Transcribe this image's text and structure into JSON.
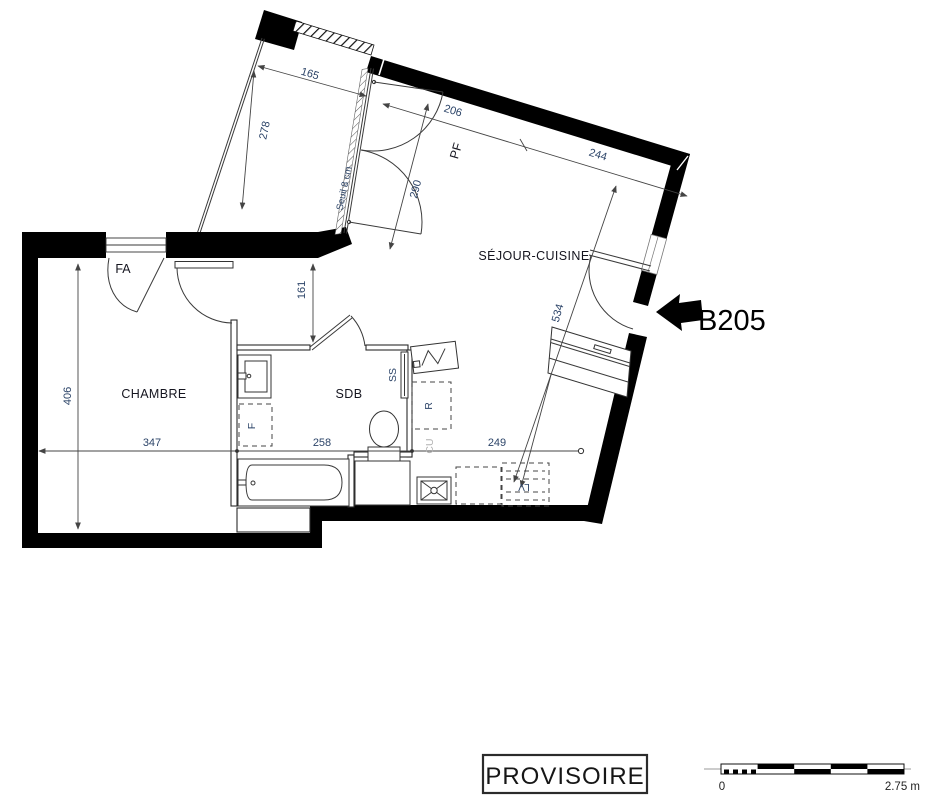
{
  "plan": {
    "unit": "B205",
    "stamp": "PROVISOIRE",
    "rooms": {
      "chambre": "CHAMBRE",
      "sdb": "SDB",
      "sejour": "SÉJOUR-CUISINE"
    },
    "annotations": {
      "fa": "FA",
      "pf": "PF",
      "seuil": "Seuil 8 cm",
      "ss": "SS",
      "f": "F",
      "r": "R",
      "cu": "CU",
      "lv": "LV"
    },
    "dims": {
      "d165": "165",
      "d278": "278",
      "d206": "206",
      "d290": "290",
      "d244": "244",
      "d161": "161",
      "d406": "406",
      "d347": "347",
      "d258": "258",
      "d249": "249",
      "d534": "534"
    },
    "scalebar": {
      "zero": "0",
      "max": "2.75 m"
    },
    "colors": {
      "wall": "#000000",
      "line": "#3a3a3a",
      "dim_text": "#2c4468",
      "label_text": "#15151f",
      "muted_text": "#b3b3b3"
    }
  }
}
